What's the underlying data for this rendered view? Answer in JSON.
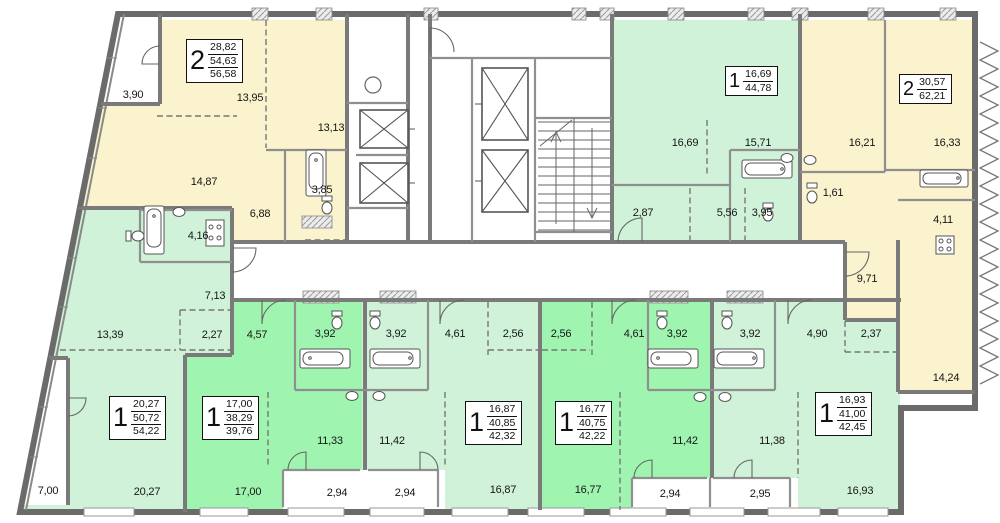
{
  "colors": {
    "yellow": "#faf3cd",
    "green_light": "#cff2d8",
    "green_dark": "#9ff5b0",
    "wall_dark": "#6b6b6b",
    "wall_mid": "#7a7a7a",
    "wall_light": "#8f8f8f",
    "fixture": "#555555",
    "text": "#161616"
  },
  "apartments": [
    {
      "type": "2",
      "areas": [
        "28,82",
        "54,63",
        "56,58"
      ]
    },
    {
      "type": "1",
      "areas": [
        "20,27",
        "50,72",
        "54,22"
      ]
    },
    {
      "type": "1",
      "areas": [
        "17,00",
        "38,29",
        "39,76"
      ]
    },
    {
      "type": "1",
      "areas": [
        "16,87",
        "40,85",
        "42,32"
      ]
    },
    {
      "type": "1",
      "areas": [
        "16,77",
        "40,75",
        "42,22"
      ]
    },
    {
      "type": "1",
      "areas": [
        "16,93",
        "41,00",
        "42,45"
      ]
    },
    {
      "type": "1",
      "areas": [
        "16,69",
        "44,78"
      ]
    },
    {
      "type": "2",
      "areas": [
        "30,57",
        "62,21"
      ]
    }
  ],
  "room_labels": [
    "3,90",
    "13,95",
    "13,13",
    "14,87",
    "3,85",
    "6,88",
    "4,16",
    "7,13",
    "13,39",
    "2,27",
    "4,57",
    "3,92",
    "3,92",
    "4,61",
    "2,56",
    "2,56",
    "4,61",
    "3,92",
    "3,92",
    "4,90",
    "2,37",
    "7,00",
    "20,27",
    "17,00",
    "11,33",
    "11,42",
    "2,94",
    "2,94",
    "16,87",
    "16,77",
    "11,42",
    "11,38",
    "2,94",
    "2,95",
    "16,93",
    "16,69",
    "15,71",
    "2,87",
    "5,56",
    "3,95",
    "1,61",
    "16,21",
    "16,33",
    "4,11",
    "9,71",
    "14,24"
  ]
}
